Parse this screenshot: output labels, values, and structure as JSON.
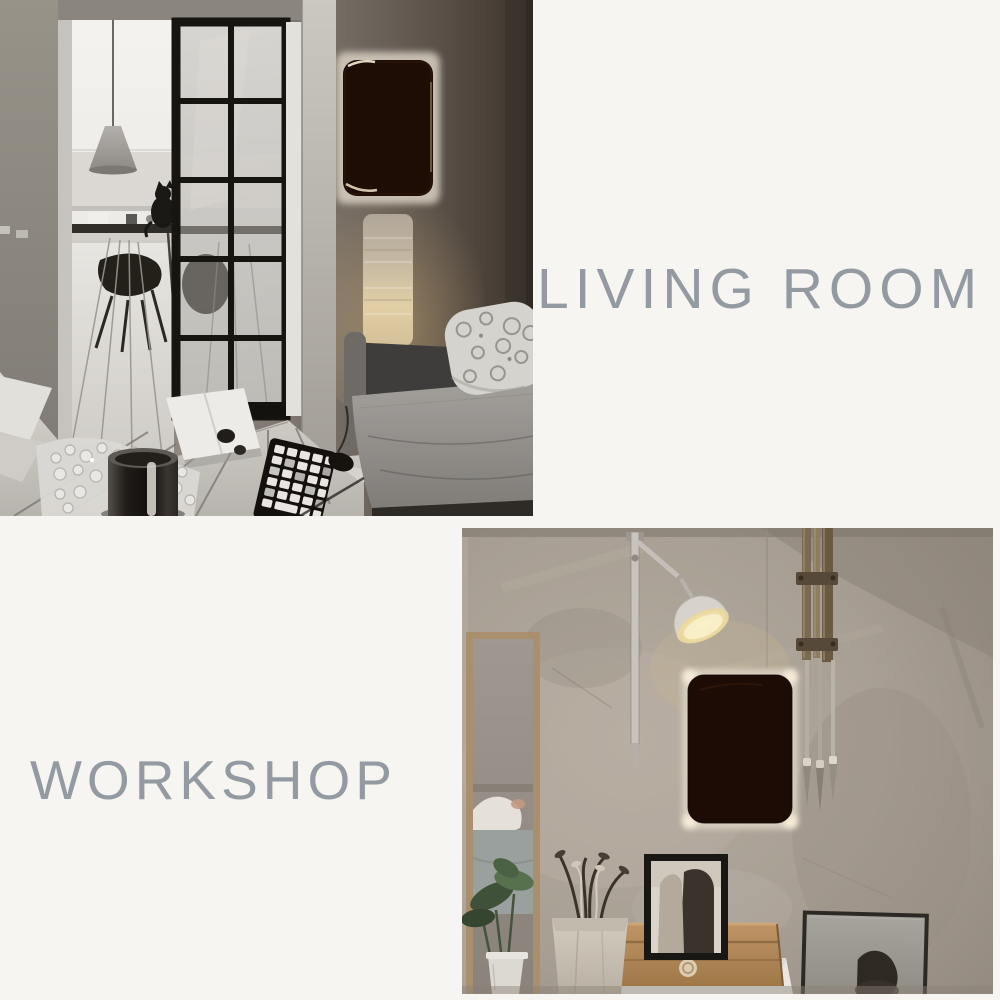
{
  "page": {
    "background_color": "#f6f5f1",
    "label_color": "#939aa1"
  },
  "sections": {
    "living_room": {
      "label": "LIVING ROOM"
    },
    "workshop": {
      "label": "WORKSHOP"
    }
  },
  "palette": {
    "living_wall_dark": "#3f362e",
    "living_wall_light": "#9b958e",
    "door_frame_black": "#17150f",
    "wall_panel_dark": "#1d0d05",
    "panel_glow": "#f6ecd8",
    "paper_lamp_warm": "#e2cfa6",
    "workshop_wall": "#a89f94",
    "cardboard_box": "#bf9465",
    "mirror_frame_wood": "#a98f6d"
  }
}
